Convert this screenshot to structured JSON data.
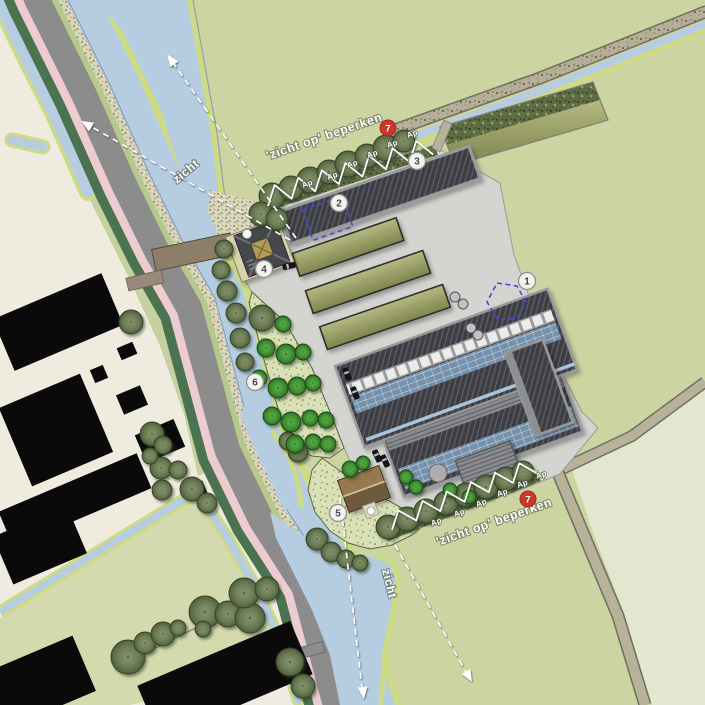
{
  "annotations": {
    "restrict_view_top": "'zicht op' beperken",
    "restrict_view_bottom": "'zicht op' beperken",
    "view_label_northwest": "zicht",
    "view_label_south": "zicht",
    "tree_row_label": "Ap"
  },
  "markers": {
    "m1": {
      "label": "1"
    },
    "m2": {
      "label": "2"
    },
    "m3": {
      "label": "3"
    },
    "m4": {
      "label": "4"
    },
    "m5": {
      "label": "5"
    },
    "m6": {
      "label": "6"
    },
    "m7_top": {
      "label": "7"
    },
    "m7_bottom": {
      "label": "7"
    }
  },
  "legend_colors": {
    "field_green": "#ccd4a2",
    "field_pale": "#e4e7d0",
    "village_ground": "#efecdf",
    "water": "#b5cce1",
    "bank_green": "#ccdb84",
    "road_gray": "#8c8c8c",
    "bike_path_pink": "#ecccd0",
    "verge_dark_green": "#4b7350",
    "farm_yard_gray": "#d4d5d0",
    "barn_roof_dark": "#3d3e43",
    "solar_panel_blue": "#7691ab",
    "marker_red": "#c9392b",
    "sketch_blue": "#4247e0"
  }
}
